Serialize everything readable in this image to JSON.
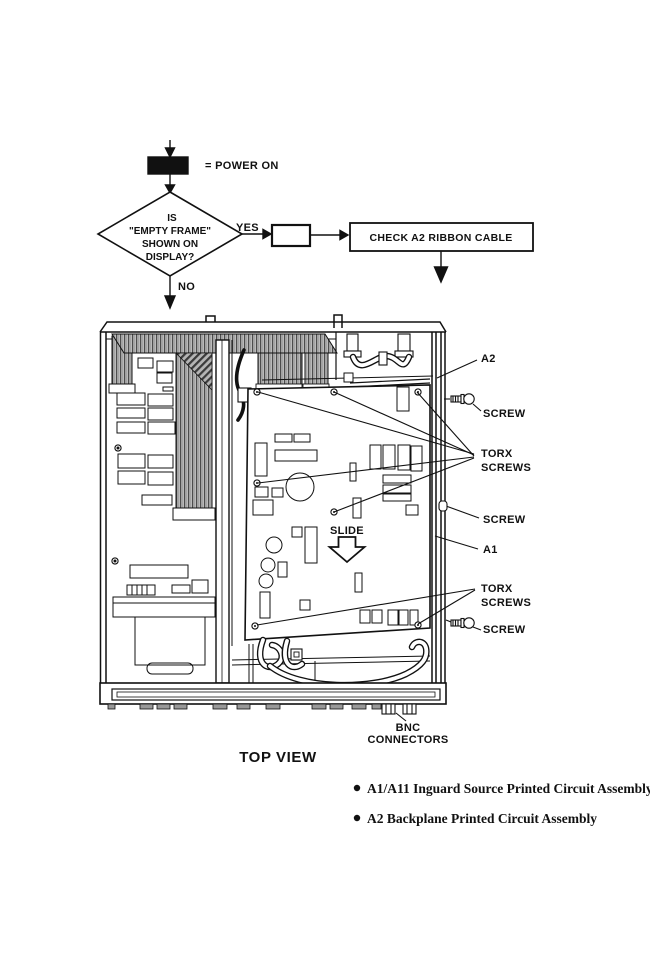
{
  "flow": {
    "power_on": "= POWER ON",
    "decision": {
      "line1": "IS",
      "line2": "\"EMPTY FRAME\"",
      "line3": "SHOWN ON",
      "line4": "DISPLAY?"
    },
    "yes": "YES",
    "no": "NO",
    "action": "CHECK A2 RIBBON CABLE"
  },
  "diagram": {
    "labels": {
      "a2": "A2",
      "screw_top": "SCREW",
      "torx_top": [
        "TORX",
        "SCREWS"
      ],
      "screw_mid": "SCREW",
      "a1": "A1",
      "torx_bottom": [
        "TORX",
        "SCREWS"
      ],
      "screw_bottom": "SCREW",
      "slide": "SLIDE",
      "bnc": [
        "BNC",
        "CONNECTORS"
      ]
    },
    "caption": "TOP VIEW"
  },
  "legend": {
    "items": [
      {
        "text": "A1/A11 Inguard Source Printed Circuit Assembly"
      },
      {
        "text": "A2 Backplane Printed Circuit Assembly"
      }
    ]
  },
  "colors": {
    "ink": "#111111",
    "paper": "#ffffff"
  }
}
